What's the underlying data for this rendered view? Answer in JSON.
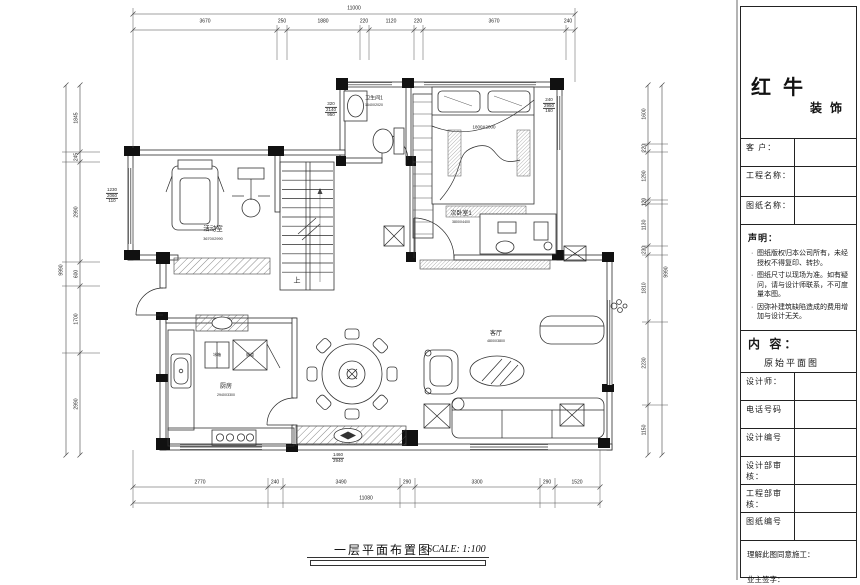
{
  "sheet": {
    "title": "一层平面布置图",
    "scale_label": "SCALE: 1:100"
  },
  "title_block": {
    "brand_cn_large": "红牛",
    "brand_cn_small": "装饰",
    "client_label": "客 户：",
    "project_label": "工程名称：",
    "drawing_label": "图纸名称：",
    "statement_heading": "声明：",
    "statement_items": [
      "图纸版权归本公司所有，未经授权不得复印、转抄。",
      "图纸尺寸以现场为准。如有疑问，请与设计师联系，不可度量本图。",
      "因弥补建筑缺陷造成的费用增加与设计无关。"
    ],
    "content_heading": "内 容：",
    "content_value": "原始平面图",
    "info_fields": [
      "设计师：",
      "电话号码",
      "设计编号",
      "设计部审核：",
      "工程部审核：",
      "图纸编号"
    ],
    "footer_confirm": "理解此图同意施工：",
    "footer_sign": "业主签字："
  },
  "plan": {
    "rooms": [
      "活动室",
      "卫生间1",
      "次卧室1",
      "客厅",
      "厨房"
    ],
    "labels": [
      {
        "name": "dim-top-total",
        "text": "11000",
        "x": 354,
        "y": 9,
        "size": 5
      },
      {
        "name": "dim-top",
        "text": "3670",
        "x": 205,
        "y": 22,
        "size": 5
      },
      {
        "name": "dim-top",
        "text": "250",
        "x": 282,
        "y": 22,
        "size": 5
      },
      {
        "name": "dim-top",
        "text": "1880",
        "x": 323,
        "y": 22,
        "size": 5
      },
      {
        "name": "dim-top",
        "text": "220",
        "x": 364,
        "y": 22,
        "size": 5
      },
      {
        "name": "dim-top",
        "text": "1120",
        "x": 391,
        "y": 22,
        "size": 5
      },
      {
        "name": "dim-top",
        "text": "220",
        "x": 418,
        "y": 22,
        "size": 5
      },
      {
        "name": "dim-top",
        "text": "3670",
        "x": 494,
        "y": 22,
        "size": 5
      },
      {
        "name": "dim-top",
        "text": "240",
        "x": 568,
        "y": 22,
        "size": 5
      },
      {
        "name": "dim-bottom",
        "text": "2770",
        "x": 200,
        "y": 483,
        "size": 5
      },
      {
        "name": "dim-bottom",
        "text": "240",
        "x": 275,
        "y": 483,
        "size": 5
      },
      {
        "name": "dim-bottom",
        "text": "3490",
        "x": 341,
        "y": 483,
        "size": 5
      },
      {
        "name": "dim-bottom",
        "text": "290",
        "x": 407,
        "y": 483,
        "size": 5
      },
      {
        "name": "dim-bottom",
        "text": "3300",
        "x": 477,
        "y": 483,
        "size": 5
      },
      {
        "name": "dim-bottom",
        "text": "290",
        "x": 547,
        "y": 483,
        "size": 5
      },
      {
        "name": "dim-bottom",
        "text": "1520",
        "x": 577,
        "y": 483,
        "size": 5
      },
      {
        "name": "dim-bottom-total",
        "text": "11080",
        "x": 366,
        "y": 499,
        "size": 5
      },
      {
        "name": "dim-left",
        "text": "1845",
        "x": 77,
        "y": 118,
        "rot": -90,
        "size": 5
      },
      {
        "name": "dim-left",
        "text": "245",
        "x": 77,
        "y": 157,
        "rot": -90,
        "size": 5
      },
      {
        "name": "dim-left",
        "text": "2990",
        "x": 77,
        "y": 212,
        "rot": -90,
        "size": 5
      },
      {
        "name": "dim-left",
        "text": "600",
        "x": 77,
        "y": 274,
        "rot": -90,
        "size": 5
      },
      {
        "name": "dim-left",
        "text": "1700",
        "x": 77,
        "y": 319,
        "rot": -90,
        "size": 5
      },
      {
        "name": "dim-left",
        "text": "2990",
        "x": 77,
        "y": 404,
        "rot": -90,
        "size": 5
      },
      {
        "name": "dim-left-total",
        "text": "9990",
        "x": 62,
        "y": 270,
        "rot": -90,
        "size": 5
      },
      {
        "name": "dim-right",
        "text": "1600",
        "x": 645,
        "y": 114,
        "rot": -90,
        "size": 5
      },
      {
        "name": "dim-right",
        "text": "220",
        "x": 645,
        "y": 148,
        "rot": -90,
        "size": 5
      },
      {
        "name": "dim-right",
        "text": "1290",
        "x": 645,
        "y": 176,
        "rot": -90,
        "size": 5
      },
      {
        "name": "dim-right",
        "text": "120",
        "x": 645,
        "y": 202,
        "rot": -90,
        "size": 5
      },
      {
        "name": "dim-right",
        "text": "1130",
        "x": 645,
        "y": 225,
        "rot": -90,
        "size": 5
      },
      {
        "name": "dim-right",
        "text": "230",
        "x": 645,
        "y": 250,
        "rot": -90,
        "size": 5
      },
      {
        "name": "dim-right",
        "text": "1810",
        "x": 645,
        "y": 288,
        "rot": -90,
        "size": 5
      },
      {
        "name": "dim-right",
        "text": "2230",
        "x": 645,
        "y": 363,
        "rot": -90,
        "size": 5
      },
      {
        "name": "dim-right",
        "text": "1150",
        "x": 645,
        "y": 430,
        "rot": -90,
        "size": 5
      },
      {
        "name": "dim-right-total",
        "text": "9990",
        "x": 667,
        "y": 272,
        "rot": -90,
        "size": 5
      },
      {
        "name": "window-callout",
        "lines": [
          "1230",
          "2060",
          "110"
        ],
        "x": 112,
        "y": 196,
        "size": 4.5
      },
      {
        "name": "window-callout",
        "lines": [
          "320",
          "2140",
          "950"
        ],
        "x": 331,
        "y": 110,
        "size": 4.5
      },
      {
        "name": "window-callout",
        "lines": [
          "240",
          "2950",
          "160"
        ],
        "x": 549,
        "y": 106,
        "size": 4.5
      },
      {
        "name": "window-callout",
        "lines": [
          "1460",
          "2940"
        ],
        "x": 338,
        "y": 458,
        "size": 4.5
      },
      {
        "name": "room-label-activity",
        "text": "活动室",
        "x": 213,
        "y": 230,
        "size": 6.5
      },
      {
        "name": "room-size-activity",
        "text": "3670X2990",
        "x": 213,
        "y": 239,
        "size": 3.8
      },
      {
        "name": "room-label-bathroom1",
        "text": "卫生间1",
        "x": 374,
        "y": 99,
        "size": 5
      },
      {
        "name": "room-size-bathroom1",
        "text": "1640X2020",
        "x": 374,
        "y": 106,
        "size": 3.5
      },
      {
        "name": "room-label-bedroom1",
        "text": "次卧室1",
        "x": 461,
        "y": 214,
        "size": 6
      },
      {
        "name": "room-size-bedroom1",
        "text": "3800X4400",
        "x": 461,
        "y": 223,
        "size": 3.5
      },
      {
        "name": "bed-size-label",
        "text": "1800X2000",
        "x": 484,
        "y": 128,
        "size": 4.5
      },
      {
        "name": "room-label-living",
        "text": "客厅",
        "x": 496,
        "y": 334,
        "size": 6
      },
      {
        "name": "room-size-living",
        "text": "4800X3800",
        "x": 496,
        "y": 342,
        "size": 3.5
      },
      {
        "name": "room-label-kitchen",
        "text": "厨房",
        "x": 226,
        "y": 387,
        "size": 6
      },
      {
        "name": "room-size-kitchen",
        "text": "2940X3300",
        "x": 226,
        "y": 396,
        "size": 3.5
      },
      {
        "name": "fridge-label",
        "text": "冰箱",
        "x": 217,
        "y": 355,
        "size": 4
      },
      {
        "name": "flue-label",
        "text": "烟道",
        "x": 250,
        "y": 355,
        "size": 4
      },
      {
        "name": "stairs-up-label",
        "text": "上",
        "x": 297,
        "y": 281,
        "size": 7
      }
    ]
  }
}
